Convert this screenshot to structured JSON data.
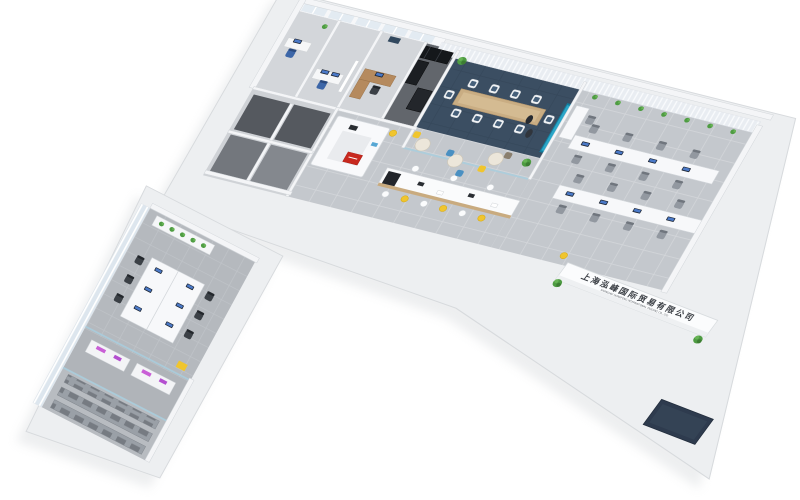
{
  "scene": {
    "title": "3D isometric office floor plan rendering",
    "background": "#ffffff",
    "reception_sign": {
      "text_cn": "上海泓峰国际贸易有限公司",
      "text_en": "SHANGHAI HONGFENG INTERNATIONAL TRADING CO., LTD"
    },
    "reception_logo_color": "#c8281e",
    "palette": {
      "slab": "#edeff1",
      "floor_tile": "#c4c8cd",
      "wing_carpet": "#b5b9be",
      "meeting_carpet": "#3b4e62",
      "dark_room_floor": "#55595f",
      "accent_teal": "#1a84ad",
      "accent_yellow": "#f0c52e",
      "accent_blue": "#57a7d4",
      "accent_red": "#c8281e",
      "accent_purple": "#c95fd6",
      "plant_green": "#4e9c42",
      "wood": "#c9ad83",
      "chair_dark": "#3b4046"
    },
    "areas": [
      {
        "name": "private-office-1"
      },
      {
        "name": "private-office-2"
      },
      {
        "name": "manager-office"
      },
      {
        "name": "storage-room-black-cabinets"
      },
      {
        "name": "meeting-room"
      },
      {
        "name": "open-office-right-wing"
      },
      {
        "name": "reception-desk"
      },
      {
        "name": "pantry-bar"
      },
      {
        "name": "corridor-small-rooms"
      },
      {
        "name": "open-office-left-wing"
      },
      {
        "name": "lab-workstations"
      },
      {
        "name": "archive-shelving-room"
      },
      {
        "name": "entrance-mat"
      }
    ],
    "counts": {
      "meeting_chairs": 10,
      "bar_stools": 9,
      "right_wing_workstations": 9,
      "left_wing_workstations": 6,
      "archive_shelf_rows": 3
    }
  }
}
